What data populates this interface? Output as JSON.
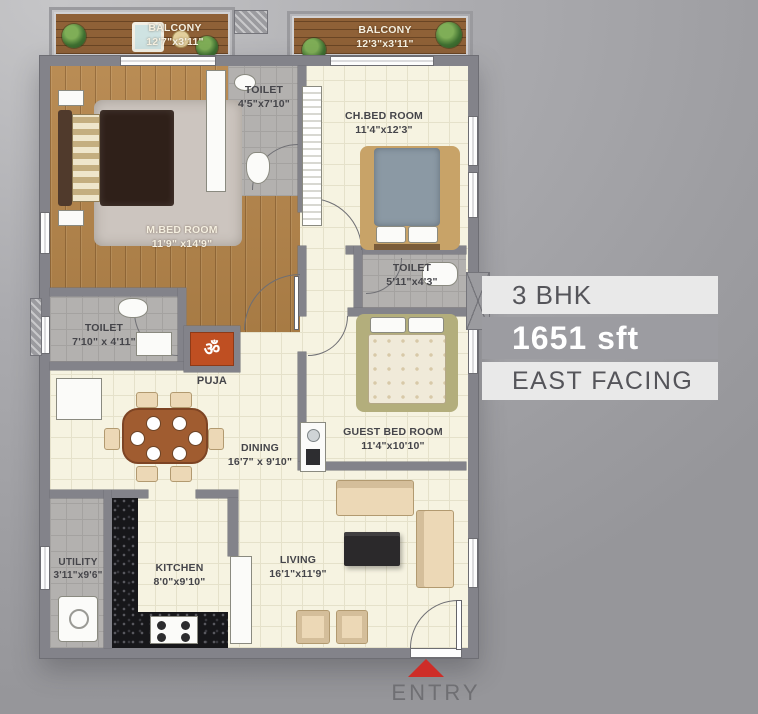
{
  "panel": {
    "bhk": "3 BHK",
    "area": "1651 sft",
    "facing": "EAST FACING"
  },
  "entry_label": "ENTRY",
  "rooms": {
    "balcony_left": {
      "name": "BALCONY",
      "dims": "12'7\"x3'11\""
    },
    "balcony_right": {
      "name": "BALCONY",
      "dims": "12'3\"x3'11\""
    },
    "toilet_top": {
      "name": "TOILET",
      "dims": "4'5\"x7'10\""
    },
    "ch_bed": {
      "name": "CH.BED ROOM",
      "dims": "11'4\"x12'3\""
    },
    "m_bed": {
      "name": "M.BED ROOM",
      "dims": "11'9\" x14'9\""
    },
    "toilet_mid": {
      "name": "TOILET",
      "dims": "5'11\"x4'3\""
    },
    "toilet_left": {
      "name": "TOILET",
      "dims": "7'10\" x 4'11\""
    },
    "puja": {
      "name": "PUJA"
    },
    "guest_bed": {
      "name": "GUEST BED ROOM",
      "dims": "11'4\"x10'10\""
    },
    "dining": {
      "name": "DINING",
      "dims": "16'7\" x 9'10\""
    },
    "utility": {
      "name": "UTILITY",
      "dims": "3'11\"x9'6\""
    },
    "kitchen": {
      "name": "KITCHEN",
      "dims": "8'0\"x9'10\""
    },
    "living": {
      "name": "LIVING",
      "dims": "16'1\"x11'9\""
    }
  },
  "icons": {
    "om": "ॐ"
  },
  "colors": {
    "entry_red": "#ce2d28",
    "puja_orange": "#bf4f22",
    "wall_gray": "#83838a",
    "floor_cream": "#f6f3e1",
    "band_light": "#e9e9e9",
    "band_dark": "#9c9ca1"
  }
}
